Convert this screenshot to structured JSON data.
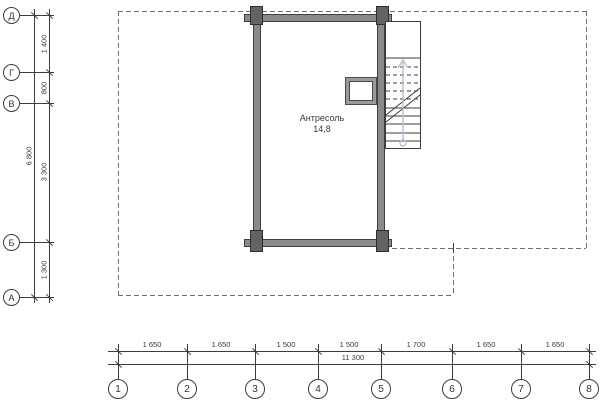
{
  "drawing": {
    "type": "floor-plan",
    "room": {
      "name": "Антресоль",
      "area": "14,8"
    }
  },
  "axes": {
    "left": {
      "markers": [
        {
          "label": "Д"
        },
        {
          "label": "Г"
        },
        {
          "label": "В"
        },
        {
          "label": "Б"
        },
        {
          "label": "А"
        }
      ],
      "segments": [
        "1 400",
        "800",
        "3 300",
        "1 300"
      ],
      "total": "6 800"
    },
    "bottom": {
      "markers": [
        {
          "label": "1"
        },
        {
          "label": "2"
        },
        {
          "label": "3"
        },
        {
          "label": "4"
        },
        {
          "label": "5"
        },
        {
          "label": "6"
        },
        {
          "label": "7"
        },
        {
          "label": "8"
        }
      ],
      "segments": [
        "1 650",
        "1 650",
        "1 500",
        "1 500",
        "1 700",
        "1 650",
        "1 650"
      ],
      "total": "11 300"
    }
  },
  "colors": {
    "wall_fill": "#8a8a8a",
    "column_fill": "#636363",
    "line": "#3c3c3c",
    "dashed_outline": "#6e6e6e",
    "stair_arrow": "#b5bfcc",
    "background": "#ffffff"
  }
}
